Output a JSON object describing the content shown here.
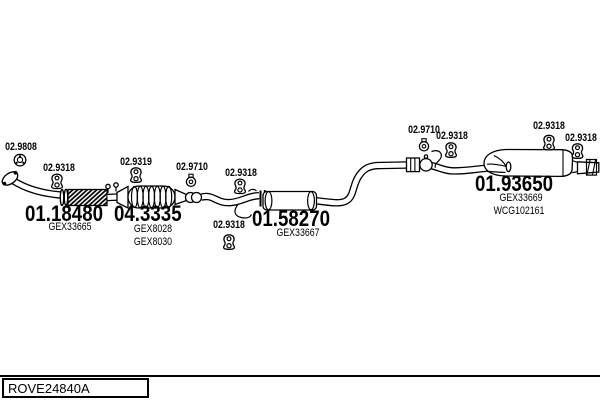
{
  "ref_code": "ROVE24840A",
  "colors": {
    "ink": "#000000",
    "paper": "#ffffff"
  },
  "parts": [
    {
      "number": "01.18480",
      "oem_refs": [
        "GEX33665"
      ]
    },
    {
      "number": "04.3335",
      "oem_refs": [
        "GEX8028",
        "GEX8030"
      ]
    },
    {
      "number": "01.58270",
      "oem_refs": [
        "GEX33667"
      ]
    },
    {
      "number": "01.93650",
      "oem_refs": [
        "GEX33669",
        "WCG102161"
      ]
    }
  ],
  "fittings": [
    {
      "number": "02.9808",
      "icon": "flange-gasket-icon"
    },
    {
      "number": "02.9318",
      "icon": "rubber-mount-icon"
    },
    {
      "number": "02.9319",
      "icon": "rubber-mount-icon"
    },
    {
      "number": "02.9710",
      "icon": "clamp-ring-icon"
    },
    {
      "number": "02.9318",
      "icon": "rubber-mount-icon"
    },
    {
      "number": "02.9318",
      "icon": "rubber-mount-icon"
    },
    {
      "number": "02.9710",
      "icon": "clamp-ring-icon"
    },
    {
      "number": "02.9318",
      "icon": "rubber-mount-icon"
    },
    {
      "number": "02.9318",
      "icon": "rubber-mount-icon"
    },
    {
      "number": "02.9318",
      "icon": "rubber-mount-icon"
    }
  ]
}
